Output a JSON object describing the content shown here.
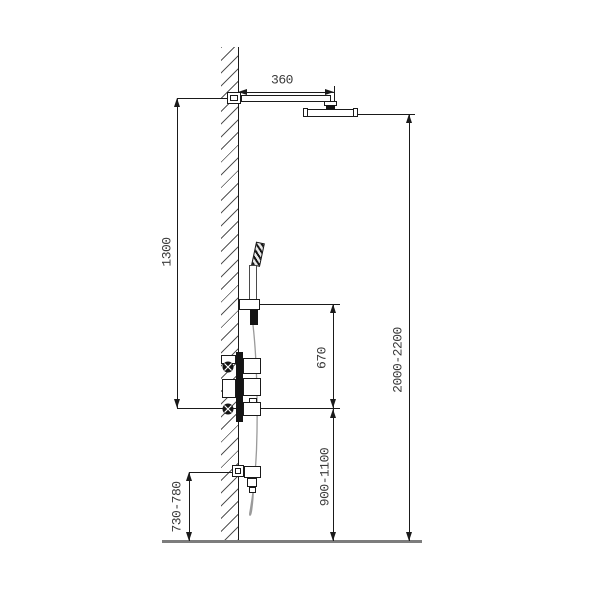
{
  "title": "shower-system-installation-drawing",
  "labels": {
    "arm_projection": "360",
    "slide_bar_length": "1300",
    "holder_to_valve": "670",
    "overall_height": "2000-2200",
    "valve_height": "900-1100",
    "outlet_height": "730-780"
  },
  "colors": {
    "line": "#1a1a1a",
    "text": "#3a3a3a",
    "floor": "#7d7d7d",
    "hose": "#9a9a9a",
    "background": "#ffffff"
  }
}
